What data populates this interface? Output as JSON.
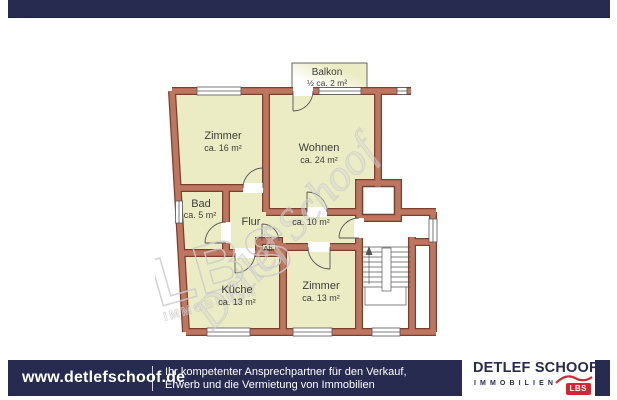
{
  "colors": {
    "navy": "#272b50",
    "wall_fill": "#bf7660",
    "wall_outline": "#7a3f2d",
    "room_fill": "#ececc4",
    "lbs_red": "#d22730",
    "watermark_gray": "#cccccc"
  },
  "floorplan": {
    "balkon": {
      "name": "Balkon",
      "area": "½ ca. 2 m²"
    },
    "rooms": [
      {
        "name": "Zimmer",
        "area": "ca. 16 m²"
      },
      {
        "name": "Wohnen",
        "area": "ca. 24 m²"
      },
      {
        "name": "Bad",
        "area": "ca. 5 m²"
      },
      {
        "name": "Flur",
        "area": "ca. 10 m²"
      },
      {
        "name": "Ab."
      },
      {
        "name": "Küche",
        "area": "ca. 13 m²"
      },
      {
        "name": "Zimmer",
        "area": "ca. 13 m²"
      }
    ],
    "watermark": {
      "script": "Detlef Schoof",
      "logo": "LBS",
      "logo_sub": "IMMOBILIEN"
    }
  },
  "footer": {
    "website": "www.detlefschoof.de",
    "slogan_line1": "Ihr kompetenter Ansprechpartner für den Verkauf,",
    "slogan_line2": "Erwerb und die Vermietung von Immobilien",
    "logo": {
      "name": "DETLEF SCHOOF",
      "subtitle": "IMMOBILIEN",
      "badge": "LBS"
    }
  }
}
